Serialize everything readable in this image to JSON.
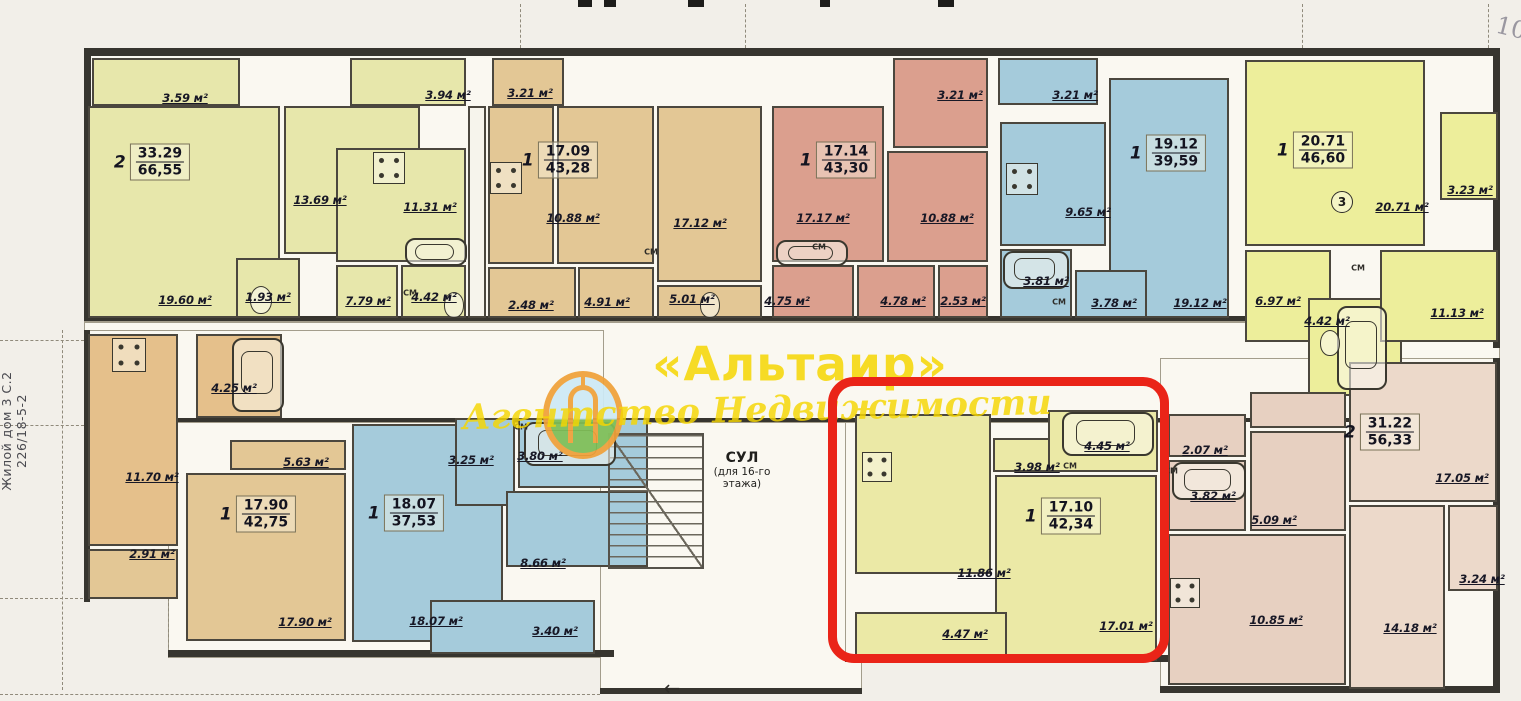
{
  "watermark": {
    "title": "«Альтаир»",
    "subtitle": "Агентство Недвижимости",
    "color": "#f6d602"
  },
  "annotations": {
    "left_note_line1": "Жилой дом 3 С.2",
    "left_note_line2": "226/18-5-2",
    "corner_note": "10",
    "circled_number": "3",
    "entrance_arrow": "←"
  },
  "stairwell": {
    "label": "СУЛ",
    "sublabel_line1": "(для 16-го",
    "sublabel_line2": "этажа)"
  },
  "closet_label": "СМ",
  "highlight": {
    "color": "#ea2418",
    "x": 828,
    "y": 377,
    "w": 341,
    "h": 286
  },
  "colors": {
    "py": "#e7e7ab",
    "yl": "#edee9b",
    "cr": "#ebe9a6",
    "tn": "#e3c795",
    "ot": "#e5c08b",
    "sl": "#db9f8e",
    "bl": "#a5cbdb",
    "pk": "#e7d0c1",
    "pk2": "#ecd9ca",
    "wh": "#f6f4ec"
  },
  "stamps": [
    {
      "rooms": "2",
      "living": "33.29",
      "total": "66,55",
      "x": 152,
      "y": 162
    },
    {
      "rooms": "1",
      "living": "17.09",
      "total": "43,28",
      "x": 560,
      "y": 160
    },
    {
      "rooms": "1",
      "living": "17.14",
      "total": "43,30",
      "x": 838,
      "y": 160
    },
    {
      "rooms": "1",
      "living": "19.12",
      "total": "39,59",
      "x": 1168,
      "y": 153
    },
    {
      "rooms": "1",
      "living": "20.71",
      "total": "46,60",
      "x": 1315,
      "y": 150
    },
    {
      "rooms": "1",
      "living": "17.90",
      "total": "42,75",
      "x": 258,
      "y": 514
    },
    {
      "rooms": "1",
      "living": "18.07",
      "total": "37,53",
      "x": 406,
      "y": 513
    },
    {
      "rooms": "1",
      "living": "17.10",
      "total": "42,34",
      "x": 1063,
      "y": 516
    },
    {
      "rooms": "2",
      "living": "31.22",
      "total": "56,33",
      "x": 1382,
      "y": 432
    }
  ],
  "labels": [
    {
      "t": "3.59 м²",
      "x": 185,
      "y": 98
    },
    {
      "t": "13.69 м²",
      "x": 320,
      "y": 200
    },
    {
      "t": "19.60 м²",
      "x": 185,
      "y": 300
    },
    {
      "t": "1.93 м²",
      "x": 268,
      "y": 297
    },
    {
      "t": "3.94 м²",
      "x": 448,
      "y": 95
    },
    {
      "t": "11.31 м²",
      "x": 430,
      "y": 207
    },
    {
      "t": "7.79 м²",
      "x": 368,
      "y": 301
    },
    {
      "t": "4.42 м²",
      "x": 434,
      "y": 297
    },
    {
      "t": "3.21 м²",
      "x": 530,
      "y": 93
    },
    {
      "t": "10.88 м²",
      "x": 573,
      "y": 218
    },
    {
      "t": "2.48 м²",
      "x": 531,
      "y": 305
    },
    {
      "t": "4.91 м²",
      "x": 607,
      "y": 302
    },
    {
      "t": "17.12 м²",
      "x": 700,
      "y": 223
    },
    {
      "t": "5.01 м²",
      "x": 692,
      "y": 299
    },
    {
      "t": "17.17 м²",
      "x": 823,
      "y": 218
    },
    {
      "t": "4.75 м²",
      "x": 787,
      "y": 301
    },
    {
      "t": "3.21 м²",
      "x": 960,
      "y": 95
    },
    {
      "t": "10.88 м²",
      "x": 947,
      "y": 218
    },
    {
      "t": "4.78 м²",
      "x": 903,
      "y": 301
    },
    {
      "t": "2.53 м²",
      "x": 963,
      "y": 301
    },
    {
      "t": "3.21 м²",
      "x": 1075,
      "y": 95
    },
    {
      "t": "9.65 м²",
      "x": 1088,
      "y": 212
    },
    {
      "t": "3.81 м²",
      "x": 1046,
      "y": 281
    },
    {
      "t": "3.78 м²",
      "x": 1114,
      "y": 303
    },
    {
      "t": "19.12 м²",
      "x": 1200,
      "y": 303
    },
    {
      "t": "20.71 м²",
      "x": 1402,
      "y": 207
    },
    {
      "t": "3.23 м²",
      "x": 1470,
      "y": 190
    },
    {
      "t": "6.97 м²",
      "x": 1278,
      "y": 301
    },
    {
      "t": "4.42 м²",
      "x": 1327,
      "y": 321
    },
    {
      "t": "11.13 м²",
      "x": 1457,
      "y": 313
    },
    {
      "t": "4.25 м²",
      "x": 234,
      "y": 388
    },
    {
      "t": "11.70 м²",
      "x": 152,
      "y": 477
    },
    {
      "t": "2.91 м²",
      "x": 152,
      "y": 554
    },
    {
      "t": "5.63 м²",
      "x": 306,
      "y": 462
    },
    {
      "t": "17.90 м²",
      "x": 305,
      "y": 622
    },
    {
      "t": "3.25 м²",
      "x": 471,
      "y": 460
    },
    {
      "t": "3.80 м²",
      "x": 540,
      "y": 456
    },
    {
      "t": "8.66 м²",
      "x": 543,
      "y": 563
    },
    {
      "t": "18.07 м²",
      "x": 436,
      "y": 621
    },
    {
      "t": "3.40 м²",
      "x": 555,
      "y": 631
    },
    {
      "t": "3.98 м²",
      "x": 1037,
      "y": 467
    },
    {
      "t": "4.45 м²",
      "x": 1107,
      "y": 446
    },
    {
      "t": "11.86 м²",
      "x": 984,
      "y": 573
    },
    {
      "t": "4.47 м²",
      "x": 965,
      "y": 634
    },
    {
      "t": "17.01 м²",
      "x": 1126,
      "y": 626
    },
    {
      "t": "2.07 м²",
      "x": 1205,
      "y": 450
    },
    {
      "t": "3.82 м²",
      "x": 1213,
      "y": 496
    },
    {
      "t": "5.09 м²",
      "x": 1274,
      "y": 520
    },
    {
      "t": "10.85 м²",
      "x": 1276,
      "y": 620
    },
    {
      "t": "17.05 м²",
      "x": 1462,
      "y": 478
    },
    {
      "t": "3.24 м²",
      "x": 1482,
      "y": 579
    },
    {
      "t": "14.18 м²",
      "x": 1410,
      "y": 628
    }
  ],
  "closets": [
    {
      "x": 410,
      "y": 293
    },
    {
      "x": 651,
      "y": 252
    },
    {
      "x": 819,
      "y": 247
    },
    {
      "x": 1059,
      "y": 302
    },
    {
      "x": 521,
      "y": 427
    },
    {
      "x": 1070,
      "y": 466
    },
    {
      "x": 1171,
      "y": 471
    },
    {
      "x": 1358,
      "y": 268
    }
  ],
  "blocks": [
    {
      "nm": "balcony",
      "x": 92,
      "y": 58,
      "w": 148,
      "h": 48,
      "c": "py",
      "ht": 1
    },
    {
      "nm": "room",
      "x": 88,
      "y": 106,
      "w": 192,
      "h": 212,
      "c": "py"
    },
    {
      "nm": "room",
      "x": 284,
      "y": 106,
      "w": 136,
      "h": 148,
      "c": "py"
    },
    {
      "nm": "bathroom",
      "x": 236,
      "y": 258,
      "w": 64,
      "h": 60,
      "c": "py"
    },
    {
      "nm": "kitchen",
      "x": 336,
      "y": 148,
      "w": 130,
      "h": 114,
      "c": "py"
    },
    {
      "nm": "hall",
      "x": 336,
      "y": 265,
      "w": 62,
      "h": 53,
      "c": "py"
    },
    {
      "nm": "bathroom",
      "x": 401,
      "y": 265,
      "w": 65,
      "h": 53,
      "c": "py"
    },
    {
      "nm": "balcony",
      "x": 350,
      "y": 58,
      "w": 116,
      "h": 48,
      "c": "py",
      "ht": 1
    },
    {
      "nm": "shaft",
      "x": 468,
      "y": 106,
      "w": 18,
      "h": 212,
      "c": "wh",
      "sh": 1
    },
    {
      "nm": "balcony",
      "x": 492,
      "y": 58,
      "w": 72,
      "h": 48,
      "c": "tn",
      "ht": 1
    },
    {
      "nm": "kitchen",
      "x": 488,
      "y": 106,
      "w": 66,
      "h": 158,
      "c": "tn"
    },
    {
      "nm": "hall",
      "x": 488,
      "y": 267,
      "w": 88,
      "h": 51,
      "c": "tn"
    },
    {
      "nm": "room",
      "x": 557,
      "y": 106,
      "w": 97,
      "h": 158,
      "c": "tn"
    },
    {
      "nm": "hall",
      "x": 578,
      "y": 267,
      "w": 76,
      "h": 51,
      "c": "tn"
    },
    {
      "nm": "room",
      "x": 657,
      "y": 106,
      "w": 105,
      "h": 176,
      "c": "tn"
    },
    {
      "nm": "bathroom",
      "x": 657,
      "y": 285,
      "w": 105,
      "h": 33,
      "c": "tn"
    },
    {
      "nm": "room",
      "x": 772,
      "y": 106,
      "w": 112,
      "h": 156,
      "c": "sl"
    },
    {
      "nm": "bathroom",
      "x": 772,
      "y": 265,
      "w": 82,
      "h": 53,
      "c": "sl"
    },
    {
      "nm": "balcony",
      "x": 893,
      "y": 58,
      "w": 95,
      "h": 90,
      "c": "sl",
      "ht": 1
    },
    {
      "nm": "kitchen",
      "x": 887,
      "y": 151,
      "w": 101,
      "h": 111,
      "c": "sl"
    },
    {
      "nm": "hall",
      "x": 857,
      "y": 265,
      "w": 78,
      "h": 53,
      "c": "sl"
    },
    {
      "nm": "hall",
      "x": 938,
      "y": 265,
      "w": 50,
      "h": 53,
      "c": "sl"
    },
    {
      "nm": "balcony",
      "x": 998,
      "y": 58,
      "w": 100,
      "h": 47,
      "c": "bl",
      "ht": 1
    },
    {
      "nm": "kitchen",
      "x": 1000,
      "y": 122,
      "w": 106,
      "h": 124,
      "c": "bl"
    },
    {
      "nm": "room",
      "x": 1109,
      "y": 78,
      "w": 120,
      "h": 240,
      "c": "bl"
    },
    {
      "nm": "bathroom",
      "x": 1000,
      "y": 249,
      "w": 72,
      "h": 69,
      "c": "bl"
    },
    {
      "nm": "hall",
      "x": 1075,
      "y": 270,
      "w": 72,
      "h": 48,
      "c": "bl"
    },
    {
      "nm": "room",
      "x": 1245,
      "y": 60,
      "w": 180,
      "h": 186,
      "c": "yl"
    },
    {
      "nm": "balcony",
      "x": 1440,
      "y": 112,
      "w": 58,
      "h": 88,
      "c": "yl"
    },
    {
      "nm": "hall",
      "x": 1245,
      "y": 250,
      "w": 86,
      "h": 92,
      "c": "yl"
    },
    {
      "nm": "bathroom",
      "x": 1308,
      "y": 298,
      "w": 94,
      "h": 98,
      "c": "yl"
    },
    {
      "nm": "kitchen",
      "x": 1380,
      "y": 250,
      "w": 118,
      "h": 92,
      "c": "yl"
    },
    {
      "nm": "kitchen",
      "x": 88,
      "y": 334,
      "w": 90,
      "h": 212,
      "c": "ot"
    },
    {
      "nm": "bathroom",
      "x": 196,
      "y": 334,
      "w": 86,
      "h": 84,
      "c": "ot"
    },
    {
      "nm": "hall",
      "x": 230,
      "y": 440,
      "w": 116,
      "h": 30,
      "c": "tn"
    },
    {
      "nm": "room",
      "x": 186,
      "y": 473,
      "w": 160,
      "h": 168,
      "c": "tn"
    },
    {
      "nm": "balcony",
      "x": 88,
      "y": 549,
      "w": 90,
      "h": 50,
      "c": "tn",
      "ht": 1
    },
    {
      "nm": "room",
      "x": 352,
      "y": 424,
      "w": 151,
      "h": 218,
      "c": "bl"
    },
    {
      "nm": "hall",
      "x": 455,
      "y": 418,
      "w": 60,
      "h": 88,
      "c": "bl"
    },
    {
      "nm": "bathroom",
      "x": 518,
      "y": 418,
      "w": 130,
      "h": 70,
      "c": "bl"
    },
    {
      "nm": "kitchen",
      "x": 506,
      "y": 491,
      "w": 142,
      "h": 76,
      "c": "bl"
    },
    {
      "nm": "balcony",
      "x": 430,
      "y": 600,
      "w": 165,
      "h": 54,
      "c": "bl",
      "ht": 1
    },
    {
      "nm": "kitchen",
      "x": 855,
      "y": 414,
      "w": 136,
      "h": 160,
      "c": "cr"
    },
    {
      "nm": "hall",
      "x": 993,
      "y": 438,
      "w": 58,
      "h": 34,
      "c": "cr"
    },
    {
      "nm": "bathroom",
      "x": 1048,
      "y": 410,
      "w": 110,
      "h": 62,
      "c": "cr"
    },
    {
      "nm": "room",
      "x": 995,
      "y": 475,
      "w": 162,
      "h": 186,
      "c": "cr"
    },
    {
      "nm": "balcony",
      "x": 855,
      "y": 612,
      "w": 152,
      "h": 48,
      "c": "cr",
      "ht": 1
    },
    {
      "nm": "bathroom",
      "x": 1168,
      "y": 414,
      "w": 78,
      "h": 43,
      "c": "pk"
    },
    {
      "nm": "bathroom",
      "x": 1168,
      "y": 460,
      "w": 78,
      "h": 71,
      "c": "pk"
    },
    {
      "nm": "hall",
      "x": 1250,
      "y": 392,
      "w": 96,
      "h": 36,
      "c": "pk"
    },
    {
      "nm": "hall",
      "x": 1250,
      "y": 431,
      "w": 96,
      "h": 100,
      "c": "pk"
    },
    {
      "nm": "kitchen",
      "x": 1168,
      "y": 534,
      "w": 178,
      "h": 151,
      "c": "pk"
    },
    {
      "nm": "room",
      "x": 1349,
      "y": 362,
      "w": 148,
      "h": 140,
      "c": "pk2"
    },
    {
      "nm": "room",
      "x": 1349,
      "y": 505,
      "w": 96,
      "h": 184,
      "c": "pk2"
    },
    {
      "nm": "balcony",
      "x": 1448,
      "y": 505,
      "w": 50,
      "h": 86,
      "c": "pk2"
    }
  ],
  "slabs": [
    {
      "x": 84,
      "y": 50,
      "w": 1416,
      "h": 272
    },
    {
      "x": 84,
      "y": 322,
      "w": 1416,
      "h": 100
    },
    {
      "x": 84,
      "y": 330,
      "w": 520,
      "h": 232
    },
    {
      "x": 168,
      "y": 422,
      "w": 446,
      "h": 236
    },
    {
      "x": 600,
      "y": 422,
      "w": 262,
      "h": 270
    },
    {
      "x": 845,
      "y": 422,
      "w": 332,
      "h": 238
    },
    {
      "x": 1160,
      "y": 358,
      "w": 340,
      "h": 334
    }
  ],
  "walls": [
    {
      "x": 84,
      "y": 48,
      "w": 1416,
      "h": 8
    },
    {
      "x": 84,
      "y": 48,
      "w": 7,
      "h": 272
    },
    {
      "x": 1493,
      "y": 48,
      "w": 7,
      "h": 300
    },
    {
      "x": 84,
      "y": 316,
      "w": 1416,
      "h": 5
    },
    {
      "x": 84,
      "y": 418,
      "w": 1416,
      "h": 4
    },
    {
      "x": 84,
      "y": 330,
      "w": 6,
      "h": 272
    },
    {
      "x": 168,
      "y": 650,
      "w": 446,
      "h": 7
    },
    {
      "x": 600,
      "y": 688,
      "w": 262,
      "h": 6
    },
    {
      "x": 845,
      "y": 655,
      "w": 332,
      "h": 7
    },
    {
      "x": 1160,
      "y": 686,
      "w": 340,
      "h": 7
    },
    {
      "x": 1493,
      "y": 358,
      "w": 7,
      "h": 334
    }
  ],
  "stairs": {
    "x": 608,
    "y": 433,
    "w": 96,
    "h": 136
  },
  "fixtures": [
    {
      "type": "tub",
      "x": 405,
      "y": 238,
      "w": 62,
      "h": 28
    },
    {
      "type": "tub",
      "x": 776,
      "y": 240,
      "w": 72,
      "h": 26
    },
    {
      "type": "tub",
      "x": 1003,
      "y": 251,
      "w": 66,
      "h": 38
    },
    {
      "type": "tub",
      "x": 524,
      "y": 422,
      "w": 92,
      "h": 44
    },
    {
      "type": "tub",
      "x": 1062,
      "y": 412,
      "w": 92,
      "h": 44
    },
    {
      "type": "tub",
      "x": 1172,
      "y": 462,
      "w": 74,
      "h": 38
    },
    {
      "type": "tub",
      "x": 232,
      "y": 338,
      "w": 52,
      "h": 74
    },
    {
      "type": "tub",
      "x": 1337,
      "y": 306,
      "w": 50,
      "h": 84
    },
    {
      "type": "stove",
      "x": 373,
      "y": 152,
      "w": 32,
      "h": 32
    },
    {
      "type": "stove",
      "x": 490,
      "y": 162,
      "w": 32,
      "h": 32
    },
    {
      "type": "stove",
      "x": 1006,
      "y": 163,
      "w": 32,
      "h": 32
    },
    {
      "type": "stove",
      "x": 112,
      "y": 338,
      "w": 34,
      "h": 34
    },
    {
      "type": "stove",
      "x": 862,
      "y": 452,
      "w": 30,
      "h": 30
    },
    {
      "type": "stove",
      "x": 1170,
      "y": 578,
      "w": 30,
      "h": 30
    },
    {
      "type": "wc",
      "x": 250,
      "y": 286,
      "w": 22,
      "h": 28
    },
    {
      "type": "wc",
      "x": 444,
      "y": 292,
      "w": 20,
      "h": 26
    },
    {
      "type": "wc",
      "x": 700,
      "y": 292,
      "w": 20,
      "h": 26
    },
    {
      "type": "wc",
      "x": 1320,
      "y": 330,
      "w": 20,
      "h": 26
    }
  ],
  "dashes_v": [
    {
      "x": 520,
      "y": 4,
      "len": 44
    },
    {
      "x": 745,
      "y": 4,
      "len": 44
    },
    {
      "x": 1302,
      "y": 4,
      "len": 44
    },
    {
      "x": 1488,
      "y": 4,
      "len": 44
    },
    {
      "x": 62,
      "y": 330,
      "len": 360
    },
    {
      "x": 168,
      "y": 598,
      "len": 60
    }
  ],
  "dashes_h": [
    {
      "x": 0,
      "y": 340,
      "len": 84
    },
    {
      "x": 0,
      "y": 425,
      "len": 84
    },
    {
      "x": 0,
      "y": 598,
      "len": 88
    },
    {
      "x": 0,
      "y": 694,
      "len": 600
    }
  ],
  "ticks": [
    {
      "x": 578,
      "w": 14
    },
    {
      "x": 604,
      "w": 12
    },
    {
      "x": 688,
      "w": 16
    },
    {
      "x": 820,
      "w": 10
    },
    {
      "x": 938,
      "w": 16
    }
  ]
}
